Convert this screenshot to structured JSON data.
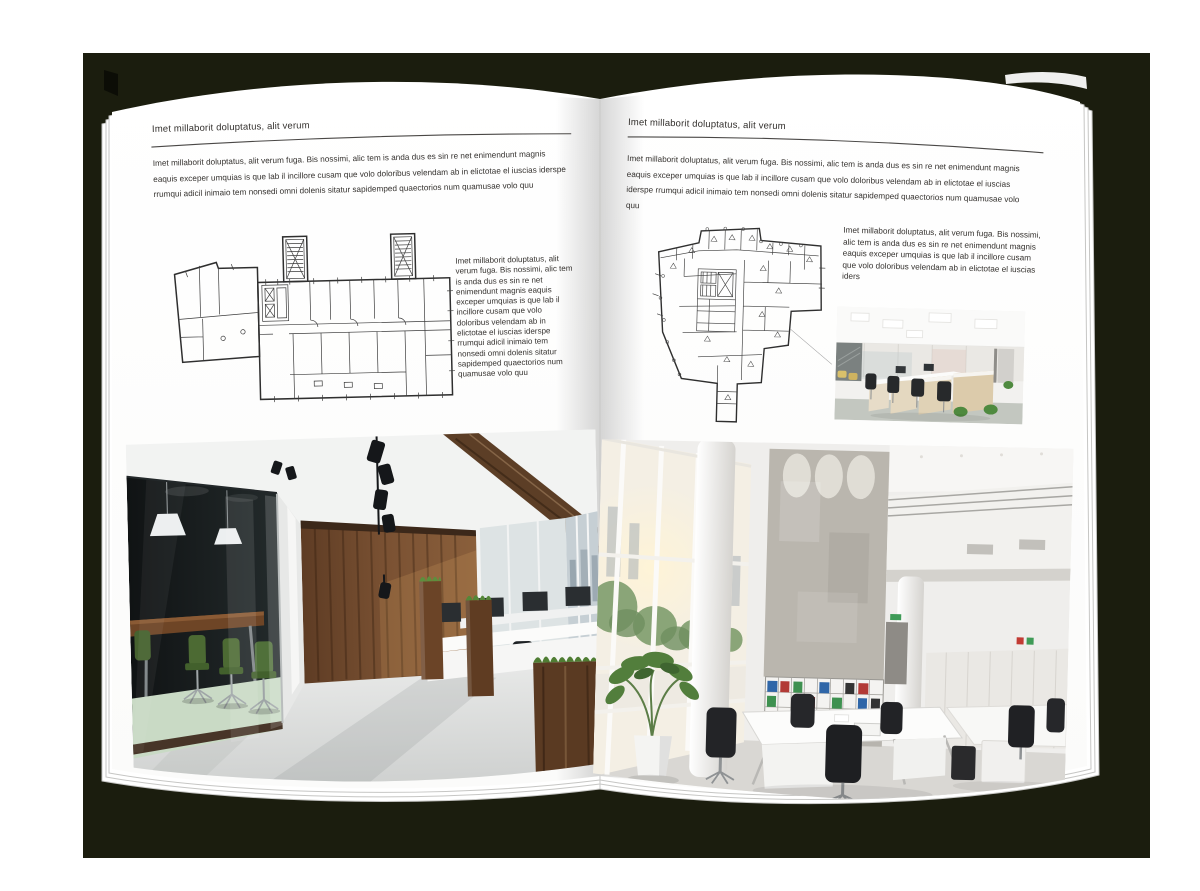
{
  "canvas": {
    "backdrop_color": "#1b1d0e",
    "page_color": "#ffffff"
  },
  "left_page": {
    "header": "Imet millaborit doluptatus, alit verum",
    "intro": "Imet millaborit doluptatus, alit verum fuga. Bis nossimi, alic tem is anda dus es sin re net enimendunt magnis eaquis exceper umquias is que lab il incillore cusam que volo doloribus velendam ab in elictotae el iuscias iderspe rrumqui adicil inimaio tem nonsedi omni dolenis sitatur sapidemped quaectorios num quamusae volo quu",
    "column": "Imet millaborit doluptatus, alit verum fuga. Bis nossimi, alic tem is anda dus es sin re net enimendunt magnis eaquis exceper umquias is que lab il incillore cusam que volo doloribus velendam ab in elictotae el iuscias iderspe rrumqui adicil inimaio tem nonsedi omni dolenis sitatur sapidemped quaectorios num quamusae volo quu",
    "images": {
      "floor_plan": "architectural-floor-plan-wide-block-with-two-stair-towers",
      "photo": "office-interior-dark-glass-meeting-room-wood-wall"
    }
  },
  "right_page": {
    "header": "Imet millaborit doluptatus, alit verum",
    "intro": "Imet millaborit doluptatus, alit verum fuga. Bis nossimi, alic tem is anda dus es sin re net enimendunt magnis eaquis exceper umquias is que lab il incillore cusam que volo doloribus velendam ab in elictotae el iuscias iderspe rrumqui adicil inimaio tem nonsedi omni dolenis sitatur sapidemped quaectorios num quamusae volo quu",
    "column": "Imet millaborit doluptatus, alit verum fuga. Bis nossimi, alic tem is anda dus es sin re net enimendunt magnis eaquis exceper umquias is que lab il incillore cusam que volo doloribus velendam ab in elictotae el iuscias iders",
    "images": {
      "floor_plan": "architectural-floor-plan-irregular-tapering-with-core",
      "photo_small": "office-interior-rows-of-desks-light-wood-cabinets",
      "photo_large": "office-interior-atrium-tall-windows-concrete-wall-binder-shelves"
    }
  }
}
